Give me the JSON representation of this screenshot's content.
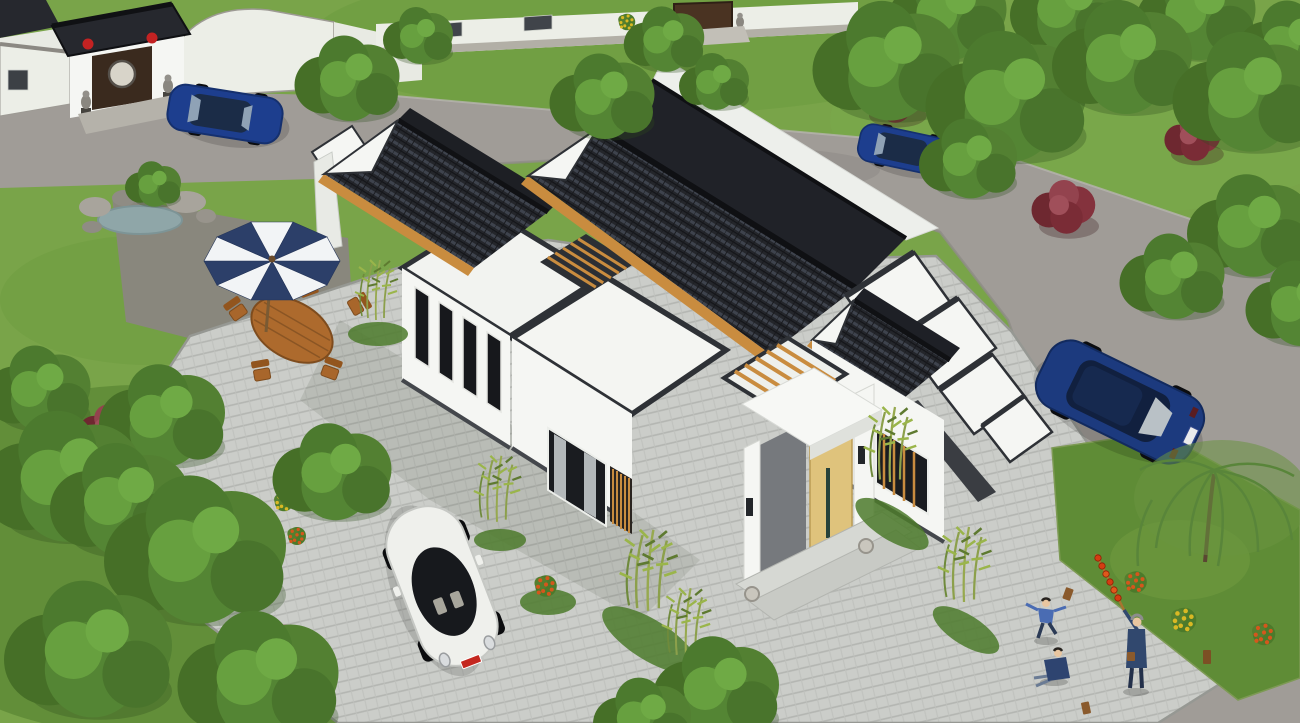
{
  "image": {
    "type": "3d-architectural-rendering",
    "description": "Aerial view of a modern single-storey Chinese-style courtyard house with white walls and dark grey tiled gable roofs, set in a landscaped residential compound with roads, parked cars, gardens and people",
    "width_px": 1300,
    "height_px": 723
  },
  "palette": {
    "grass": "#79a449",
    "grass_dark": "#5c8a34",
    "road": "#a09c97",
    "road_dark": "#8a8681",
    "paving": "#cbcdc9",
    "paving_line": "#b4b6b2",
    "curb": "#8f918c",
    "roof": "#26282e",
    "roof_row": "#3b3f48",
    "trim": "#2e3136",
    "wall": "#f5f6f3",
    "wall_shade": "#dfe1dc",
    "wood": "#c98c3f",
    "door": "#dfc37c",
    "car_blue": "#1d3e8e",
    "car_blue_dark": "#15306e",
    "car_white": "#eff0ec",
    "umb_navy": "#2c3f69",
    "umb_white": "#f2f4f6",
    "furniture": "#ad6a2d",
    "tree_green": "#4e7c2e",
    "tree_red": "#84323d",
    "flower_orange": "#d4571c",
    "flower_yellow": "#d9b824",
    "water": "#8fa6a8",
    "rock": "#a8a49c",
    "stone": "#b5b2aa",
    "lantern": "#c32222",
    "person_navy": "#3c5f9e",
    "skin": "#e9c6a0"
  },
  "scene": {
    "main_house": {
      "label": "single-storey Chinese-style house: white rendered walls, dark grey tile gable roofs with timber eave strips, flat white roof sections, inner light-well with timber pergola, entrance porch with light timber door and stone drum pedestals"
    },
    "vehicles": [
      {
        "label": "white Volkswagen Beetle parked in the front courtyard",
        "color": "white",
        "plate_color": "red"
      },
      {
        "label": "blue sedan driving on the upper-left road",
        "color": "blue"
      },
      {
        "label": "blue sedan on the upper-right road",
        "color": "blue"
      },
      {
        "label": "dark blue sedan parked on the right-hand road",
        "color": "dark blue"
      }
    ],
    "garden": {
      "patio": "blue and white striped parasol over an octagonal wooden dining table with wooden folding chairs",
      "rock_pond": "small rockery pond with boulders and a young tree",
      "plants": [
        "mature green trees",
        "red-leaf shrubs",
        "bamboo clusters along the house walls",
        "orange chrysanthemum bushes",
        "yellow chrysanthemum bushes",
        "weeping willow"
      ]
    },
    "people": [
      {
        "label": "child running across the paving, blue jacket"
      },
      {
        "label": "child sitting on the paving"
      },
      {
        "label": "adult in navy holding a pole of candied hawthorn (tanghulu)"
      }
    ],
    "neighbourhood": {
      "gate": "traditional grey-tile entrance gate with red lanterns, stone lions and round moon window (top left)",
      "wall": "white compound wall with lattice windows and timber gate flanked by stone lions (top centre)",
      "roads": "light grey concrete roads",
      "paving": "grey herringbone brick courtyard"
    }
  }
}
